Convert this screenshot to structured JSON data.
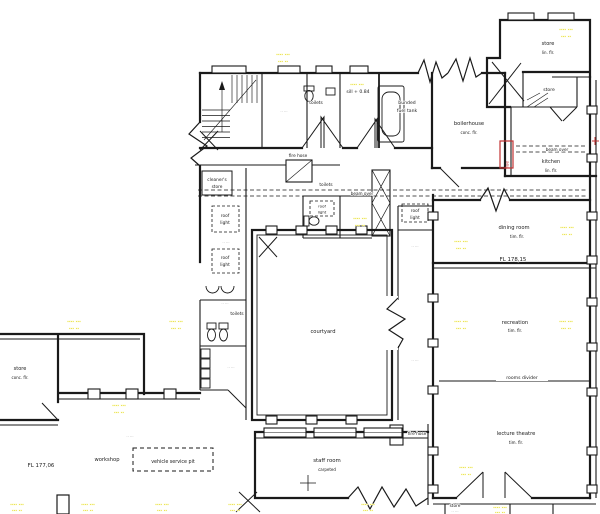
{
  "drawing": {
    "background": "#ffffff",
    "line_color": "#1a1a1a",
    "highlight_color": "#e4da2a",
    "red_color": "#c23333"
  },
  "labels": {
    "store": "store",
    "store_tr_sub": "lin. flr.",
    "store_left_sub": "conc. flr.",
    "boilerhouse": "boilerhouse",
    "boilerhouse_sub": "conc. flr.",
    "bunded1": "bunded",
    "bunded2": "fuel tank",
    "sill": "sill + 0.84",
    "toilets": "toilets",
    "kitchen": "kitchen",
    "kitchen_sub": "lin. flr.",
    "beam_over": "beam over",
    "cleaners1": "cleaner's",
    "cleaners2": "store",
    "fire_hose": "fire hose",
    "roof1": "roof",
    "roof2": "light",
    "dining": "dining room",
    "dining_sub": "tim. flr.",
    "fl_dining": "FL 178,15",
    "recreation": "recreation",
    "recreation_sub": "tim. flr.",
    "rooms_divider": "rooms divider",
    "lecture": "lecture theatre",
    "lecture_sub": "tim. flr.",
    "courtyard": "courtyard",
    "staff": "staff room",
    "staff_sub": "carpeted",
    "workshop": "workshop",
    "vehicle_pit": "vehicle service pit",
    "fl_workshop": "FL 177,06",
    "flue": "flue"
  },
  "notes": {
    "line1": "∙∙∙∙ ∙∙∙",
    "line2": "∙∙∙ ∙∙",
    "micro": "·· ···"
  }
}
